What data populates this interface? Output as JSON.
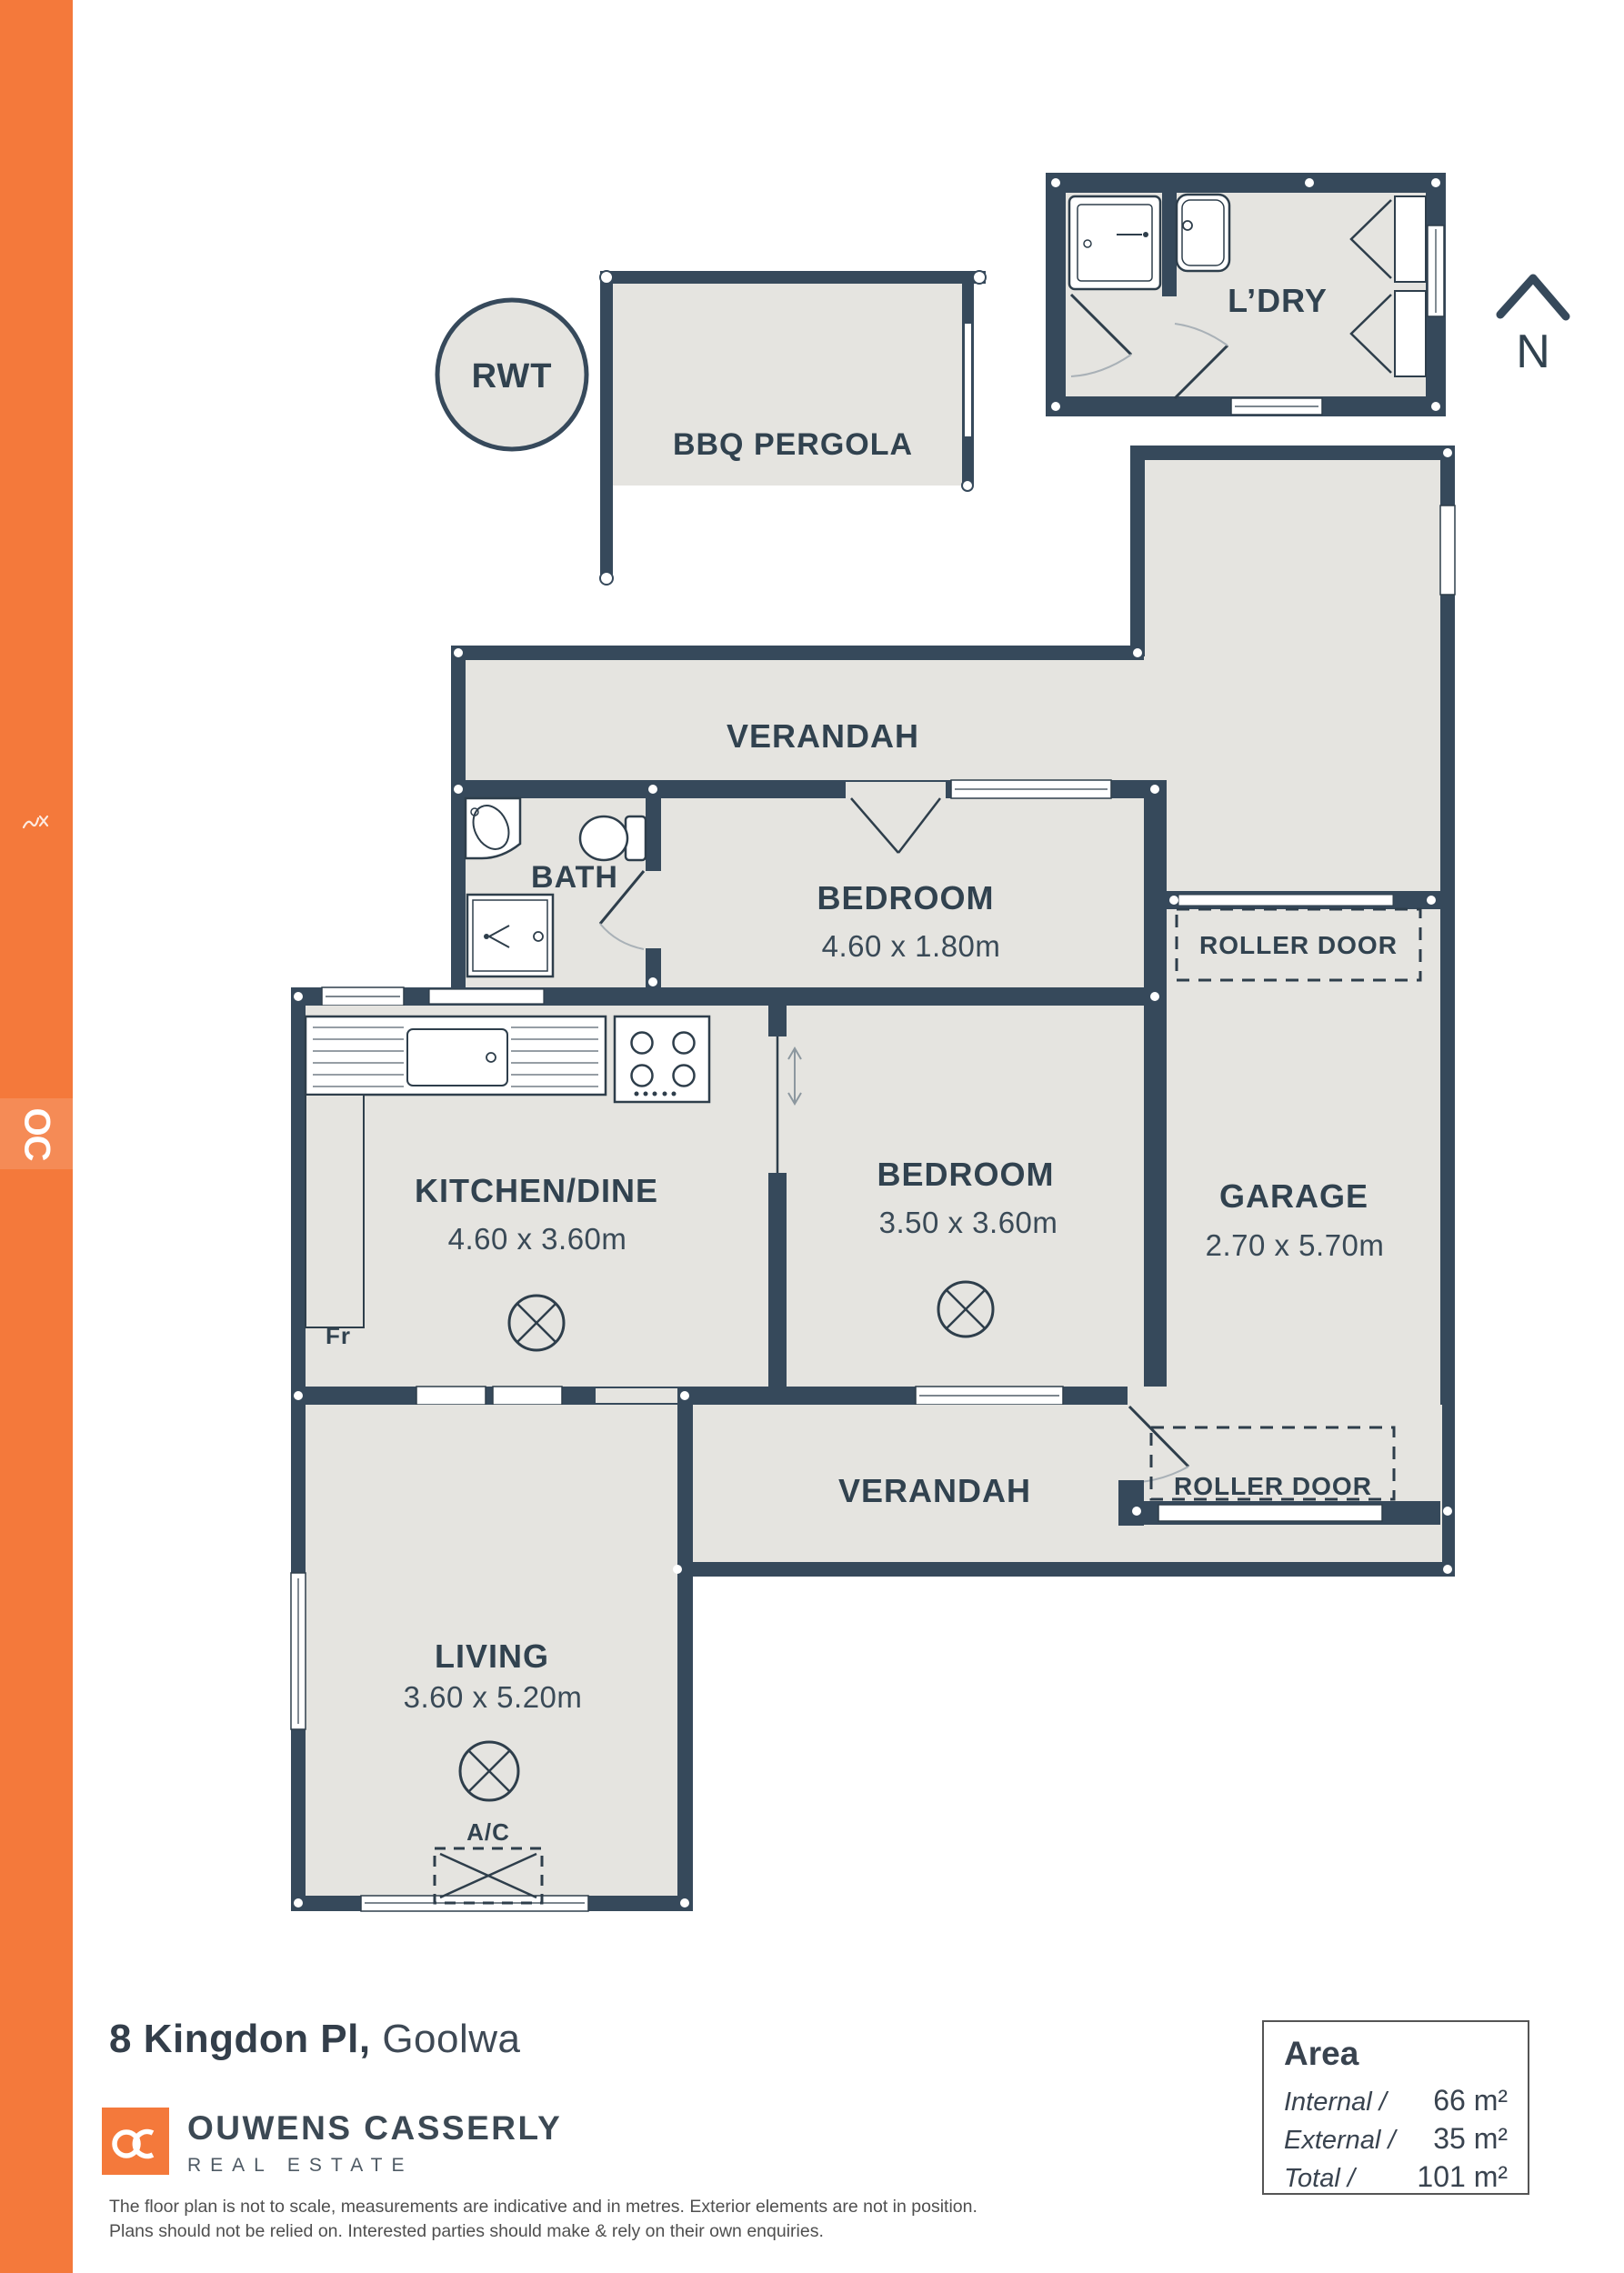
{
  "palette": {
    "wall": "#36495B",
    "floor": "#E5E4E0",
    "accent_orange": "#F4793B",
    "label": "#31424F"
  },
  "sidebar": {
    "logo_text": "OC"
  },
  "north": {
    "label": "N"
  },
  "plan": {
    "laundry": {
      "label": "L’DRY"
    },
    "rwt": {
      "label": "RWT"
    },
    "bbq_pergola": {
      "label": "BBQ PERGOLA"
    },
    "pergola": {
      "label": "PERGOLA"
    },
    "verandah_top": {
      "label": "VERANDAH"
    },
    "bath": {
      "label": "BATH"
    },
    "bedroom1": {
      "label": "BEDROOM",
      "dims": "4.60 x 1.80m"
    },
    "roller_door_top": {
      "label": "ROLLER DOOR"
    },
    "garage": {
      "label": "GARAGE",
      "dims": "2.70 x 5.70m"
    },
    "kitchen": {
      "label": "KITCHEN/DINE",
      "dims": "4.60 x 3.60m"
    },
    "fridge": {
      "label": "Fr"
    },
    "bedroom2": {
      "label": "BEDROOM",
      "dims": "3.50 x 3.60m"
    },
    "verandah_bottom": {
      "label": "VERANDAH"
    },
    "roller_door_bottom": {
      "label": "ROLLER DOOR"
    },
    "living": {
      "label": "LIVING",
      "dims": "3.60 x 5.20m"
    },
    "ac": {
      "label": "A/C"
    }
  },
  "footer": {
    "address_bold": "8 Kingdon Pl,",
    "address_suburb": " Goolwa",
    "logo_text": "OC",
    "brand_name": "OUWENS CASSERLY",
    "brand_tagline": "REAL ESTATE",
    "disclaimer_line1": "The floor plan is not to scale, measurements are indicative and in metres. Exterior elements are not in position.",
    "disclaimer_line2": "Plans should not be relied on. Interested parties should make & rely on their own enquiries."
  },
  "area_panel": {
    "title": "Area",
    "rows": [
      {
        "label": "Internal /",
        "value": "66 m²"
      },
      {
        "label": "External /",
        "value": "35 m²"
      },
      {
        "label": "Total /",
        "value": "101 m²"
      }
    ]
  }
}
